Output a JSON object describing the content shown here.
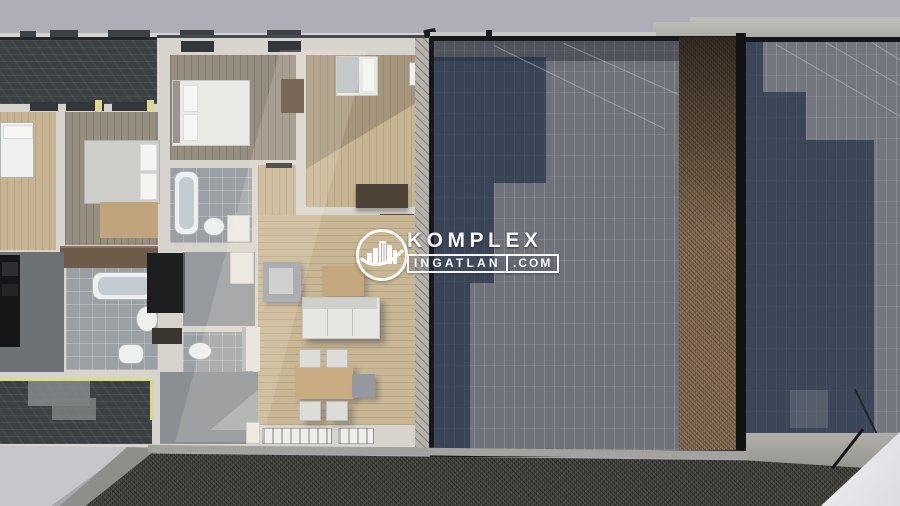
{
  "scene": {
    "type": "3d-floorplan-render-top-view",
    "description": "Photorealistic top-down render of an apartment floor plan beside flat neighbouring roofs, real-estate watermark centered",
    "background_color": "#a9a9b4"
  },
  "watermark": {
    "brand": "KOMPLEX",
    "brand_line2": "INGATLAN",
    "brand_tld": ".COM",
    "logo": "buildings-in-circle-with-swoosh",
    "color": "#ffffff"
  },
  "palette": {
    "sky": "#a9a9b4",
    "roof_tile": "#70727a",
    "roof_shadow": "#3d4a63",
    "roof_gravel_brown": "#8e7257",
    "ground_gravel": "#46453f",
    "wall": "#d7d4cd",
    "wood_light": "#c8b694",
    "wood_gray": "#968d81",
    "tile_gray": "#9ba0a5",
    "deck_dark": "#3b4042",
    "concrete": "#b7b5b0",
    "insulation_accent": "#d9da8c"
  },
  "regions": {
    "floorplan": [
      "roof-terrace-top",
      "bedroom-1",
      "bedroom-2",
      "master-bedroom",
      "bedroom-3",
      "bathroom-1",
      "bathroom-2",
      "wc",
      "entry-hall",
      "kitchen-dark",
      "living-dining",
      "terrace-deck-bottom"
    ],
    "fixtures": [
      "bed",
      "bathtub",
      "toilet",
      "sink",
      "wardrobe",
      "dresser",
      "desk",
      "sofa",
      "armchair",
      "dining-table",
      "dining-chair",
      "kitchen-island",
      "side-table"
    ],
    "roofs": [
      "center-flat-roof",
      "roof-gravel-strip",
      "right-flat-roof",
      "concrete-parapet"
    ],
    "ground": [
      "gravel-yard",
      "concrete-walkway",
      "driveway-white"
    ]
  }
}
